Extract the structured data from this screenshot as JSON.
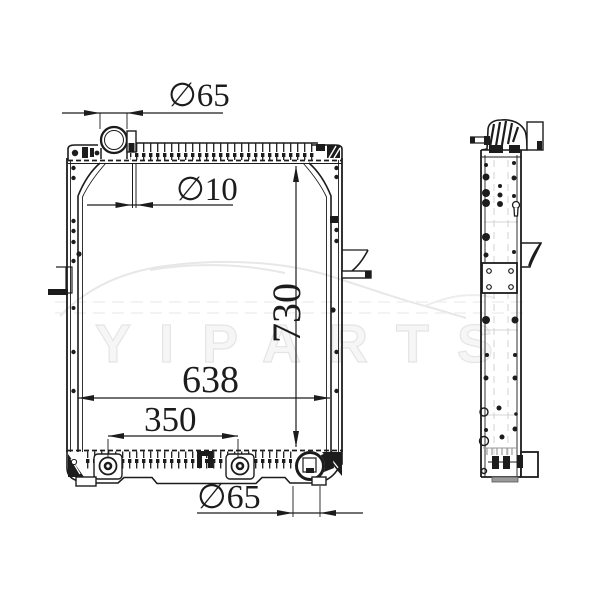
{
  "drawing": {
    "title": "radiator two-view technical drawing",
    "line_color": "#1c1c1c",
    "watermark": "YIPARTS",
    "dimensions": {
      "top_inlet_diameter": "∅65",
      "overflow_pipe_diameter": "∅10",
      "core_height": "730",
      "core_width": "638",
      "mount_spacing": "350",
      "bottom_outlet_diameter": "∅65"
    }
  }
}
